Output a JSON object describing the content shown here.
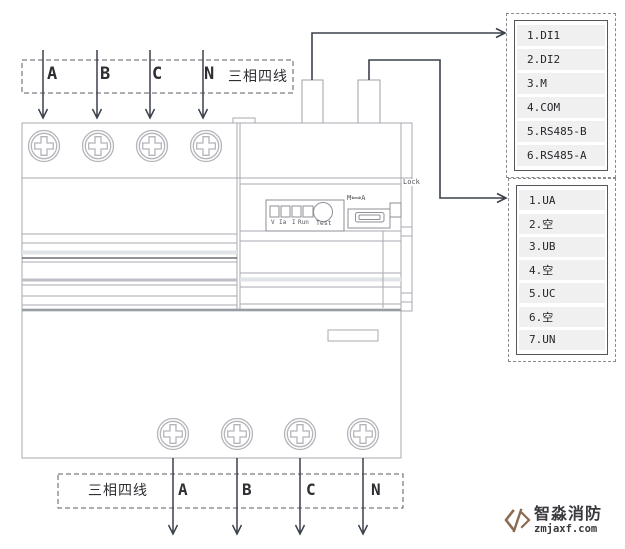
{
  "colors": {
    "device_line": "#a9a9b1",
    "wire_line": "#3c414b",
    "row_bg": "#f0f0f0",
    "logo_brown": "#8a6b52"
  },
  "top_terminal_bar": {
    "phases": [
      "A",
      "B",
      "C",
      "N"
    ],
    "wiring_label": "三相四线"
  },
  "bottom_terminal_bar": {
    "wiring_label": "三相四线",
    "phases": [
      "A",
      "B",
      "C",
      "N"
    ]
  },
  "device_panel": {
    "indicators": [
      "V",
      "Ia",
      "I",
      "Run"
    ],
    "test_label": "Test",
    "mode_switch_label": "M⟺A",
    "lock_label": "Lock"
  },
  "terminal_boxes": [
    {
      "rows": [
        "1.DI1",
        "2.DI2",
        "3.M",
        "4.COM",
        "5.RS485-B",
        "6.RS485-A"
      ]
    },
    {
      "rows": [
        "1.UA",
        "2.空",
        "3.UB",
        "4.空",
        "5.UC",
        "6.空",
        "7.UN"
      ]
    }
  ],
  "logo": {
    "company": "智淼消防",
    "website": "zmjaxf.com"
  }
}
